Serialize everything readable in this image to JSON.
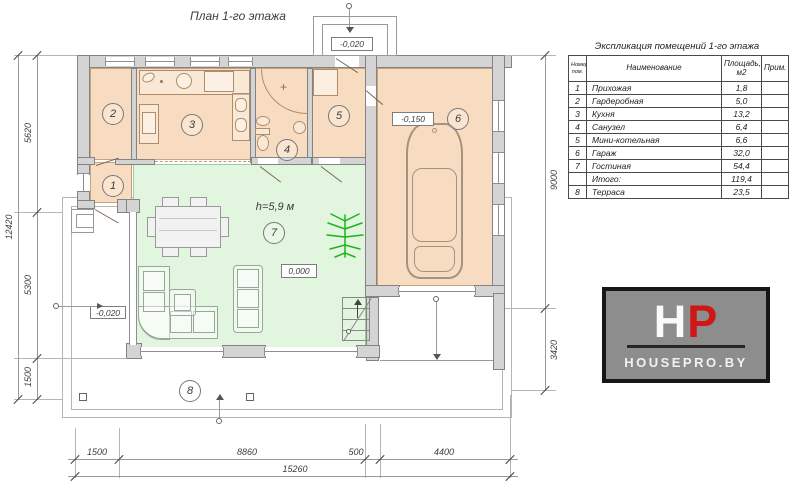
{
  "title": "План 1-го этажа",
  "plan": {
    "height_label": "h=5,9 м",
    "levels": {
      "entry": "-0,020",
      "garage": "-0,150",
      "living": "0,000",
      "terrace": "-0,020"
    },
    "room_numbers": [
      "1",
      "2",
      "3",
      "4",
      "5",
      "6",
      "7",
      "8"
    ],
    "dims": {
      "bottom": [
        "1500",
        "8860",
        "500",
        "4400"
      ],
      "bottom_total": "15260",
      "left": [
        "5620",
        "5300",
        "1500"
      ],
      "left_total": "12420",
      "right": [
        "9000",
        "3420"
      ]
    }
  },
  "table": {
    "title": "Экспликация помещений 1-го этажа",
    "col_num": "Номер пом.",
    "col_name": "Наименование",
    "col_area": "Площадь, м2",
    "col_note": "Прим.",
    "rows": [
      {
        "num": "1",
        "name": "Прихожая",
        "area": "1,8",
        "note": ""
      },
      {
        "num": "2",
        "name": "Гардеробная",
        "area": "5,0",
        "note": ""
      },
      {
        "num": "3",
        "name": "Кухня",
        "area": "13,2",
        "note": ""
      },
      {
        "num": "4",
        "name": "Санузел",
        "area": "6,4",
        "note": ""
      },
      {
        "num": "5",
        "name": "Мини-котельная",
        "area": "6,6",
        "note": ""
      },
      {
        "num": "6",
        "name": "Гараж",
        "area": "32,0",
        "note": ""
      },
      {
        "num": "7",
        "name": "Гостиная",
        "area": "54,4",
        "note": ""
      },
      {
        "num": "",
        "name": "Итого:",
        "area": "119,4",
        "note": ""
      },
      {
        "num": "8",
        "name": "Терраса",
        "area": "23,5",
        "note": ""
      }
    ]
  },
  "logo": {
    "letter_h": "H",
    "letter_p": "P",
    "site": "HOUSEPRO.BY"
  },
  "colors": {
    "room_fill": "#f8dcc1",
    "living_fill": "#e2f5de",
    "wall": "#d4d4d4",
    "accent_red": "#cf1717",
    "plant_green": "#1db41d"
  }
}
